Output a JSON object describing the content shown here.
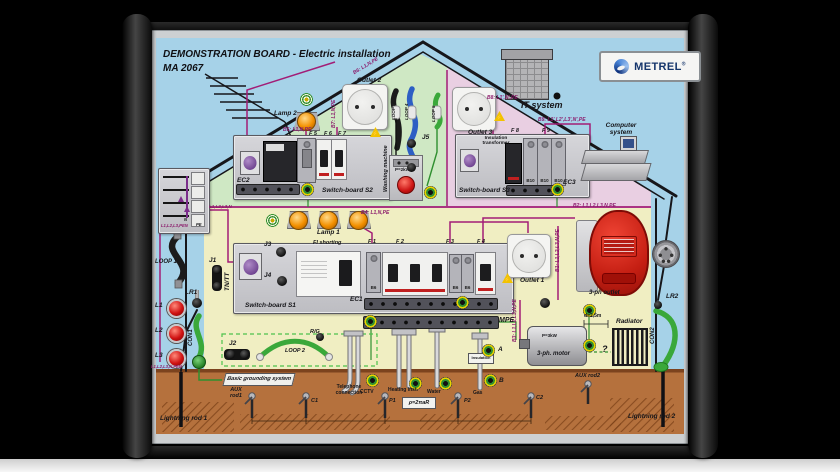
{
  "title": {
    "line1": "DEMONSTRATION BOARD  -  Electric installation",
    "line2": "MA 2067"
  },
  "brand": {
    "name": "METREL",
    "reg": "®"
  },
  "house": {
    "it_system": "IT system",
    "computer_system": "Computer system"
  },
  "devices": {
    "lamp1": "Lamp 1",
    "lamp2": "Lamp 2",
    "outlet1": "Outlet 1",
    "outlet2": "Outlet 2",
    "outlet3": "Outlet 3",
    "washing_machine": "Washing machine",
    "washing_power": "P=2kW",
    "insulation_transformer": "Insulation transformer",
    "motor": "3-ph. motor",
    "motor_power": "P=3kW",
    "radiator": "Radiator",
    "three_phase_outlet": "3-ph outlet",
    "distance": "d=2,5m",
    "question": "?"
  },
  "switchboards": {
    "s1": "Switch-board S1",
    "s2": "Switch-board S2",
    "s3": "Switch-board S3",
    "ec1": "EC1",
    "ec2": "EC2",
    "ec3": "EC3",
    "mpe": "MPE",
    "fi_shorting": "FI shorting",
    "module_b6": "B6",
    "module_b10": "B10"
  },
  "fuses": {
    "f1": "F 1",
    "f2": "F 2",
    "f3": "F 3",
    "f4": "F 4",
    "f5": "F 5",
    "f6": "F 6",
    "f7": "F 7",
    "f8": "F 8",
    "f9": "F 9"
  },
  "wires": {
    "b1": "B1: L1,L2,L3,N,PE",
    "b2": "B2: L1,L2,L3,N,PE",
    "b3": "B3: L1,L2,L3,N,PE",
    "b4": "B4: L1,N,PE",
    "b5": "B5: L1,N,PE",
    "b6": "B6: L1,N,PE",
    "b7": "B7: L1,N,PE",
    "b8": "B8: L1',N',PE",
    "b9": "B9: L1',L2',L3',N',PE",
    "bundle": "L1,L2,L3,N",
    "panel_label": "L1,L2,L3,PEN",
    "n": "N",
    "pe": "PE",
    "incoming": "L1,L2,L3,N,PEN"
  },
  "jacks": {
    "j1": "J1",
    "j2": "J2",
    "j3": "J3",
    "j4": "J4",
    "j5": "J5",
    "lr1": "LR1",
    "lr2": "LR2",
    "con1": "CON1",
    "con2": "CON2",
    "tn_tt": "TN/TT",
    "rg": "R/G"
  },
  "loops": {
    "loop1": "LOOP 1",
    "loop2": "LOOP 2",
    "loop3": "LOOP 3",
    "loop4": "LOOP 4",
    "loop5": "LOOP 5"
  },
  "phase_lamps": {
    "l1": "L1",
    "l2": "L2",
    "l3": "L3"
  },
  "grounding": {
    "basic": "Basic grounding system",
    "aux_rod1": "AUX rod1",
    "aux_rod2": "AUX rod2",
    "lightning_rod1": "Lightning rod 1",
    "lightning_rod2": "Lightning rod 2",
    "telephone": "Telephone connection",
    "cctv": "CCTV",
    "heating": "Heating inst.",
    "water": "Water",
    "gas": "Gas",
    "insulation": "Insulation",
    "p1": "P1",
    "p2": "P2",
    "c1": "C1",
    "c2": "C2",
    "a": "A",
    "b": "B",
    "rho": "ρ=2πaR"
  },
  "icons": {
    "warning_bolt": "⚡"
  },
  "colors": {
    "sky": "#a6d2e8",
    "room_green": "#cfe8c4",
    "room_pink": "#e9cfe2",
    "room_yellow": "#f0eec2",
    "ground": "#b5713d",
    "wire_magenta": "#a21d76",
    "wire_green": "#2f8f2f",
    "cable_blue": "#2d5fc4",
    "accent_red": "#d02018"
  }
}
